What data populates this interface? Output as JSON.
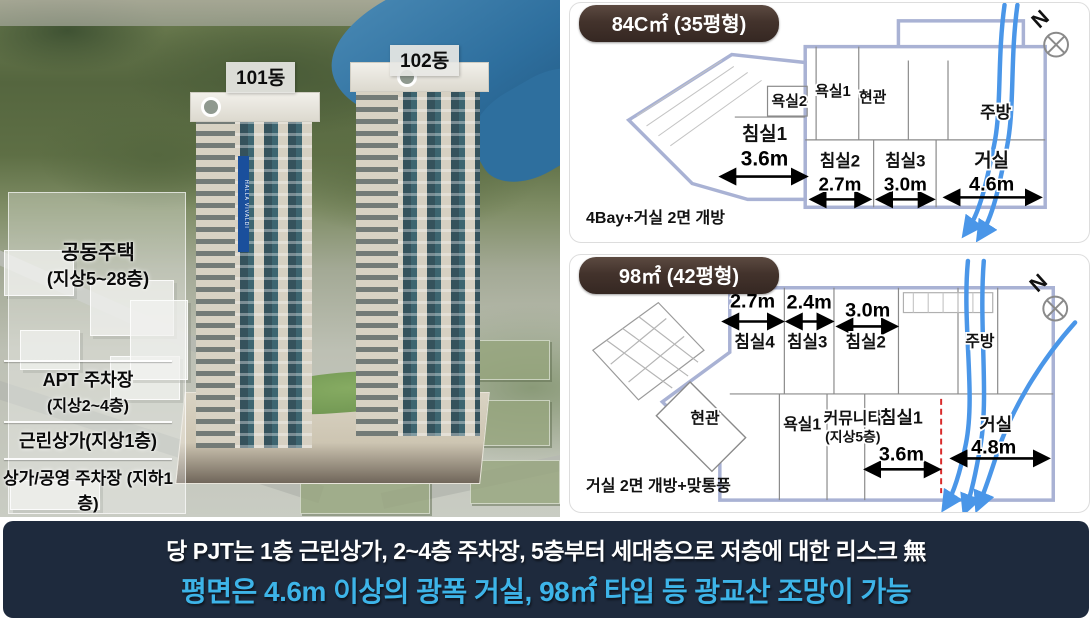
{
  "aerial": {
    "building_tags": [
      {
        "label": "101동"
      },
      {
        "label": "102동"
      }
    ],
    "zone_label": {
      "title": "공동주택",
      "sub": "(지상5~28층)"
    },
    "legend_rows": [
      {
        "title": "APT 주차장",
        "sub": "(지상2~4층)"
      },
      {
        "title": "근린상가(지상1층)"
      },
      {
        "title": "상가/공영 주차장 (지하1층)"
      }
    ],
    "tower_sign": "HALLA VIVALDI"
  },
  "plans": [
    {
      "badge": "84C㎡ (35평형)",
      "north": "N",
      "caption": "4Bay+거실 2면 개방",
      "rooms": {
        "bath2": "욕실2",
        "bath1": "욕실1",
        "entry": "현관",
        "kitchen": "주방",
        "bed1": "침실1",
        "bed1_dim": "3.6m",
        "bed2": "침실2",
        "bed2_dim": "2.7m",
        "bed3": "침실3",
        "bed3_dim": "3.0m",
        "living": "거실",
        "living_dim": "4.6m"
      }
    },
    {
      "badge": "98㎡ (42평형)",
      "north": "N",
      "caption": "거실 2면 개방+맞통풍",
      "rooms": {
        "bed4": "침실4",
        "bed4_dim": "2.7m",
        "bed3": "침실3",
        "bed3_dim": "2.4m",
        "bed2": "침실2",
        "bed2_dim": "3.0m",
        "kitchen": "주방",
        "entry": "현관",
        "bath1": "욕실1",
        "community": "커뮤니티",
        "community_sub": "(지상5층)",
        "bed1": "침실1",
        "bed1_dim": "3.6m",
        "living": "거실",
        "living_dim": "4.8m"
      }
    }
  ],
  "banner": {
    "line1": "당 PJT는 1층 근린상가, 2~4층 주차장, 5층부터 세대층으로 저층에 대한 리스크 無",
    "line2": "평면은 4.6m 이상의 광폭 거실, 98㎡ 타입 등 광교산 조망이 가능"
  },
  "colors": {
    "badge_bg": "#43332c",
    "banner_bg": "#1e2a3d",
    "banner_accent": "#3db4e8",
    "plan_outline": "#a9b2d4",
    "flow_arrow": "#4a96e8",
    "dashed_red": "#d92b2b"
  }
}
